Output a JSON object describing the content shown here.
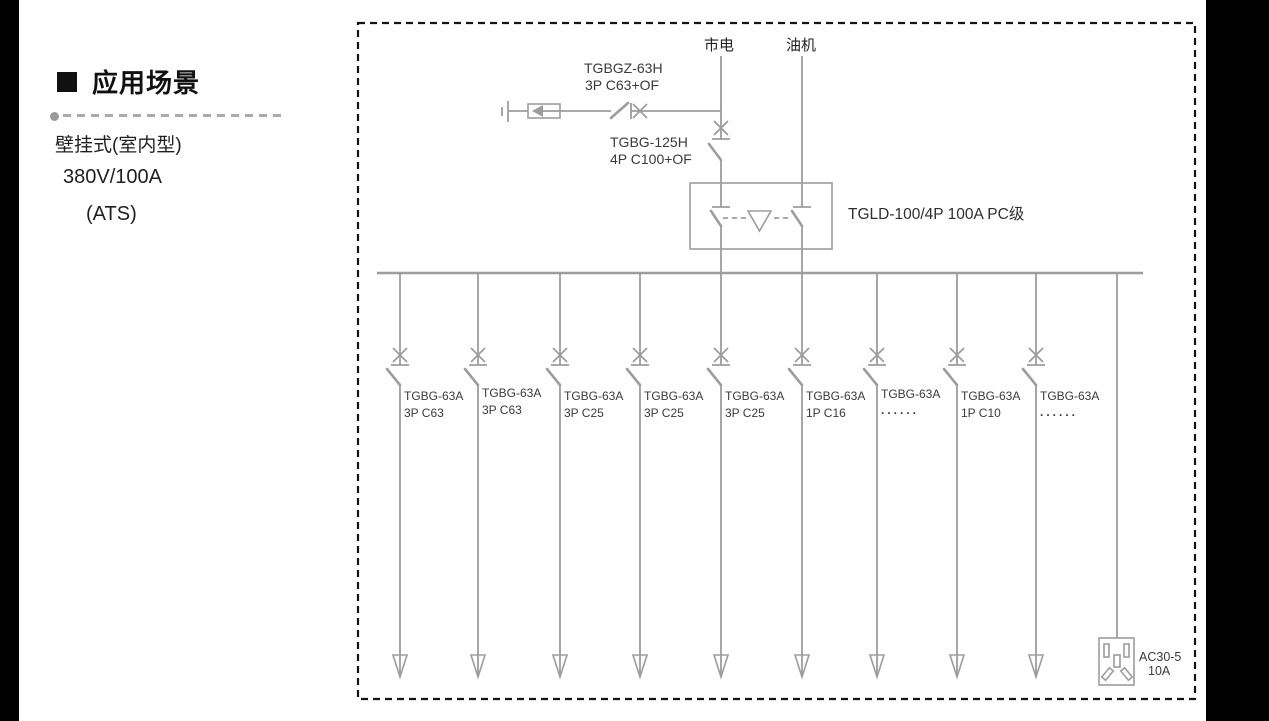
{
  "left_panel": {
    "title": "应用场景",
    "line1": "壁挂式(室内型)",
    "line2": "380V/100A",
    "line3": "(ATS)"
  },
  "diagram": {
    "sources": {
      "mains": "市电",
      "generator": "油机"
    },
    "surge_breaker": {
      "model": "TGBGZ-63H",
      "spec": "3P C63+OF"
    },
    "incoming_breaker": {
      "model": "TGBG-125H",
      "spec": "4P C100+OF"
    },
    "ats": {
      "label": "TGLD-100/4P 100A PC级"
    },
    "branches": [
      {
        "model": "TGBG-63A",
        "spec": "3P C63"
      },
      {
        "model": "TGBG-63A",
        "spec": "3P C63"
      },
      {
        "model": "TGBG-63A",
        "spec": "3P C25"
      },
      {
        "model": "TGBG-63A",
        "spec": "3P C25"
      },
      {
        "model": "TGBG-63A",
        "spec": "3P C25"
      },
      {
        "model": "TGBG-63A",
        "spec": "1P C16"
      },
      {
        "model": "TGBG-63A",
        "spec": "......"
      },
      {
        "model": "TGBG-63A",
        "spec": "1P C10"
      },
      {
        "model": "TGBG-63A",
        "spec": "......"
      }
    ],
    "socket": {
      "model": "AC30-5",
      "rating": "10A"
    }
  },
  "colors": {
    "wire_gray": "#9d9d9d",
    "label_dark": "#3a3a3a",
    "border_black": "#141414"
  }
}
